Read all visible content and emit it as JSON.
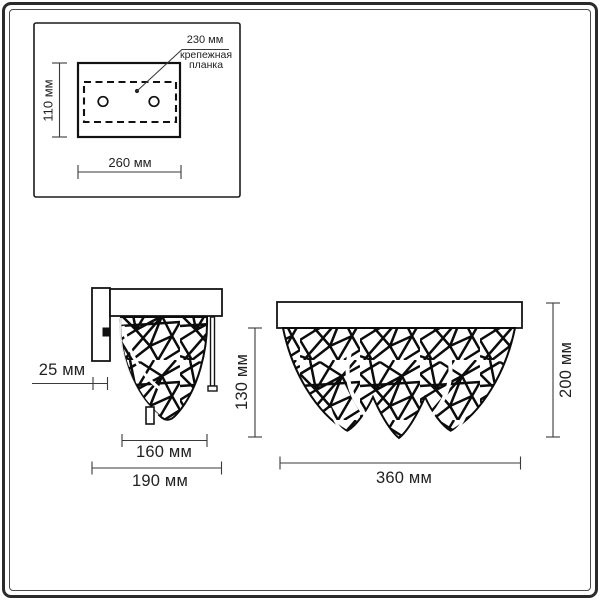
{
  "unit": "мм",
  "mounting_view": {
    "bracket_width_label": "230 мм",
    "bracket_name_line1": "крепежная",
    "bracket_name_line2": "планка",
    "height_label": "110 мм",
    "width_label": "260 мм"
  },
  "side_view": {
    "bracket_depth_label": "25 мм",
    "shade_height_label": "130 мм",
    "shade_width_label": "160 мм",
    "total_depth_label": "190 мм"
  },
  "front_view": {
    "height_label": "200 мм",
    "width_label": "360 мм"
  },
  "colors": {
    "line": "#111111",
    "dimension_line": "#3a3a3a",
    "text": "#222222",
    "background": "#ffffff"
  }
}
